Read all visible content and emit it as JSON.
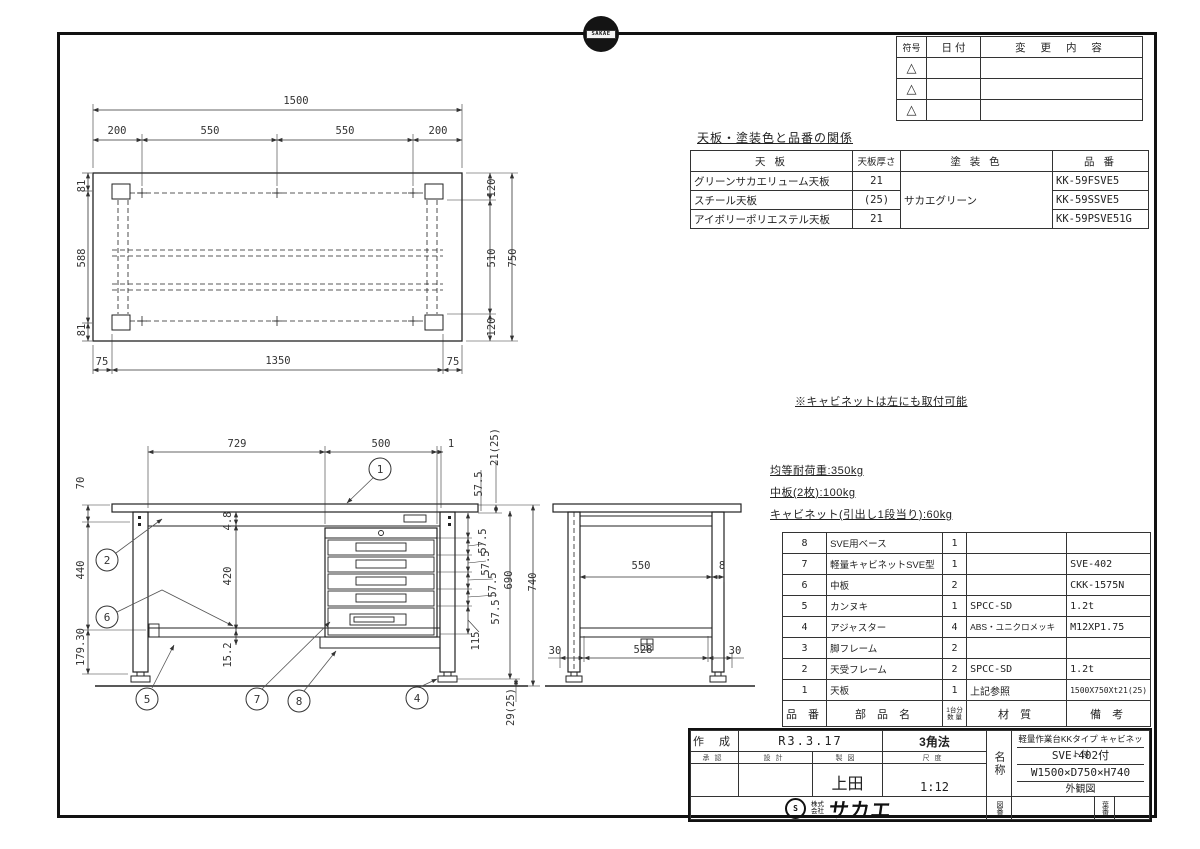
{
  "logos": {
    "top_badge": "SAKAE"
  },
  "revision_table": {
    "headers": [
      "符号",
      "日 付",
      "変 更 内 容"
    ],
    "rows": [
      {
        "sym": "△"
      },
      {
        "sym": "△"
      },
      {
        "sym": "△"
      }
    ]
  },
  "finish_table": {
    "title": "天板・塗装色と品番の関係",
    "headers": {
      "top": "天 板",
      "thickness": "天板厚さ",
      "color": "塗 装 色",
      "part_no": "品 番"
    },
    "color_value": "サカエグリーン",
    "rows": [
      {
        "top": "グリーンサカエリューム天板",
        "thickness": "21",
        "part_no": "KK-59FSVE5"
      },
      {
        "top": "スチール天板",
        "thickness": "(25)",
        "part_no": "KK-59SSVE5"
      },
      {
        "top": "アイボリーポリエステル天板",
        "thickness": "21",
        "part_no": "KK-59PSVE51G"
      }
    ]
  },
  "notes": {
    "cabinet_note": "※キャビネットは左にも取付可能",
    "load_notes": [
      "均等耐荷重:350kg",
      "中板(2枚):100kg",
      "キャビネット(引出し1段当り):60kg"
    ]
  },
  "parts_table": {
    "headers": {
      "no": "品 番",
      "name": "部 品 名",
      "qty1": "1台分",
      "qty2": "数 量",
      "material": "材 質",
      "remark": "備 考"
    },
    "rows": [
      {
        "no": "8",
        "name": "SVE用ベース",
        "qty": "1",
        "material": "",
        "remark": ""
      },
      {
        "no": "7",
        "name": "軽量キャビネットSVE型",
        "qty": "1",
        "material": "",
        "remark": "SVE-402"
      },
      {
        "no": "6",
        "name": "中板",
        "qty": "2",
        "material": "",
        "remark": "CKK-1575N"
      },
      {
        "no": "5",
        "name": "カンヌキ",
        "qty": "1",
        "material": "SPCC-SD",
        "remark": "1.2t"
      },
      {
        "no": "4",
        "name": "アジャスター",
        "qty": "4",
        "material": "ABS・ユニクロメッキ",
        "remark": "M12XP1.75"
      },
      {
        "no": "3",
        "name": "脚フレーム",
        "qty": "2",
        "material": "",
        "remark": ""
      },
      {
        "no": "2",
        "name": "天受フレーム",
        "qty": "2",
        "material": "SPCC-SD",
        "remark": "1.2t"
      },
      {
        "no": "1",
        "name": "天板",
        "qty": "1",
        "material": "上記参照",
        "remark": "1500X750Xt21(25)"
      }
    ]
  },
  "title_block": {
    "created_label": "作 成",
    "created_value": "R3.3.17",
    "projection": "3角法",
    "sign_labels": [
      "承認",
      "設計",
      "製図",
      "尺度"
    ],
    "drafter": "上田",
    "scale": "1:12",
    "name_label": "名称",
    "product": {
      "line1": "軽量作業台KKタイプ キャビネット付",
      "line2": "SVE-402付",
      "line3": "W1500×D750×H740",
      "line4": "外観図"
    },
    "dwg_no_label": "図番",
    "sheet_no_label": "葉番",
    "company": {
      "kabushiki": "株式",
      "kaisha": "会社",
      "name": "サカエ"
    }
  },
  "drawing": {
    "dims": [
      "1500",
      "200",
      "550",
      "550",
      "200",
      "81",
      "588",
      "81",
      "75",
      "1350",
      "75",
      "120",
      "510",
      "120",
      "750",
      "729",
      "500",
      "1",
      "70",
      "440",
      "179.30",
      "4.8",
      "420",
      "15.2",
      "21(25)",
      "57.5",
      "57.5",
      "57.5",
      "57.5",
      "57.5",
      "115",
      "690",
      "740",
      "29(25)",
      "550",
      "8",
      "30",
      "528",
      "30"
    ],
    "balloons": [
      "1",
      "2",
      "6",
      "5",
      "7",
      "8",
      "4"
    ]
  }
}
